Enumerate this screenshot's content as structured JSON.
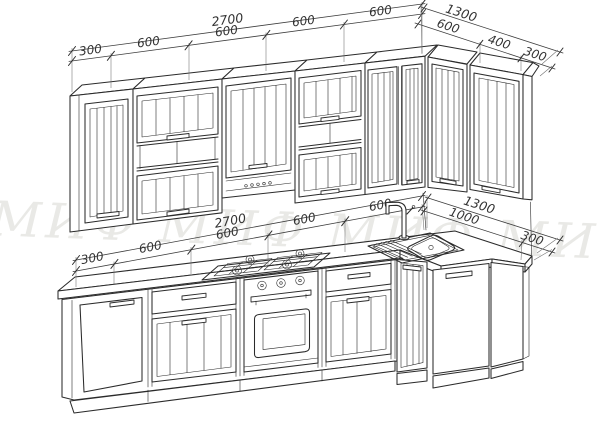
{
  "watermark": {
    "text": "МИФ МИФ МИФ МИФ",
    "color": "#e9e9e6"
  },
  "dimensions": {
    "wall_row": {
      "left_total": "2700",
      "left_segments": [
        "300",
        "600",
        "600",
        "600",
        "600"
      ],
      "right_total": "1300",
      "right_segments": [
        "600",
        "400",
        "300"
      ]
    },
    "base_row": {
      "left_total": "2700",
      "left_segments": [
        "300",
        "600",
        "600",
        "600",
        "600"
      ],
      "right_total": "1300",
      "right_segments": [
        "1000",
        "300"
      ]
    }
  },
  "scene": {
    "type": "kitchen-layout-blueprint",
    "fixtures": [
      "gas-hob",
      "built-in-oven",
      "corner-sink",
      "mixer-tap"
    ],
    "line_color": "#2b2b2b",
    "dim_color": "#3d3d3d",
    "background": "#ffffff"
  }
}
